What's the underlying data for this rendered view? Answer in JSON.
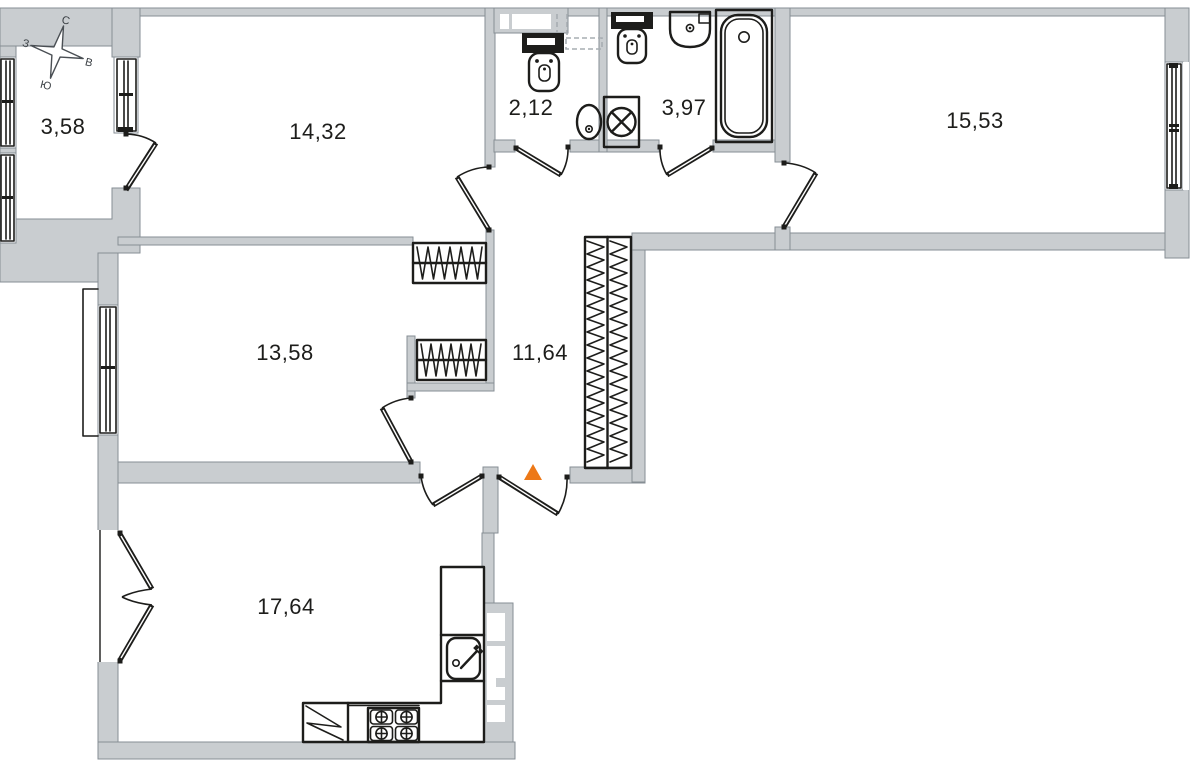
{
  "plan": {
    "type": "apartment-floor-plan",
    "rooms": {
      "balcony": {
        "area": "3,58"
      },
      "room_top": {
        "area": "14,32"
      },
      "wc": {
        "area": "2,12"
      },
      "bathroom": {
        "area": "3,97"
      },
      "room_right": {
        "area": "15,53"
      },
      "room_mid": {
        "area": "13,58"
      },
      "hallway": {
        "area": "11,64"
      },
      "kitchen_living": {
        "area": "17,64"
      }
    },
    "compass": {
      "n": "С",
      "s": "Ю",
      "w": "З",
      "e": "В"
    },
    "colors": {
      "wall_fill": "#c9cdd0",
      "wall_edge": "#868e94",
      "ink": "#1d1d1b",
      "entrance_marker": "#ED7817",
      "duct_dash": "#a7adb2"
    },
    "fixtures": [
      "toilet-wc",
      "corner-sink-wc",
      "vent-duct",
      "toilet-bath",
      "washbasin",
      "bathtub",
      "washing-machine",
      "wardrobe-1",
      "wardrobe-2",
      "hall-closet",
      "kitchen-counter",
      "kitchen-sink",
      "stove",
      "fridge"
    ],
    "entrance_marker_shape": "triangle-up"
  }
}
